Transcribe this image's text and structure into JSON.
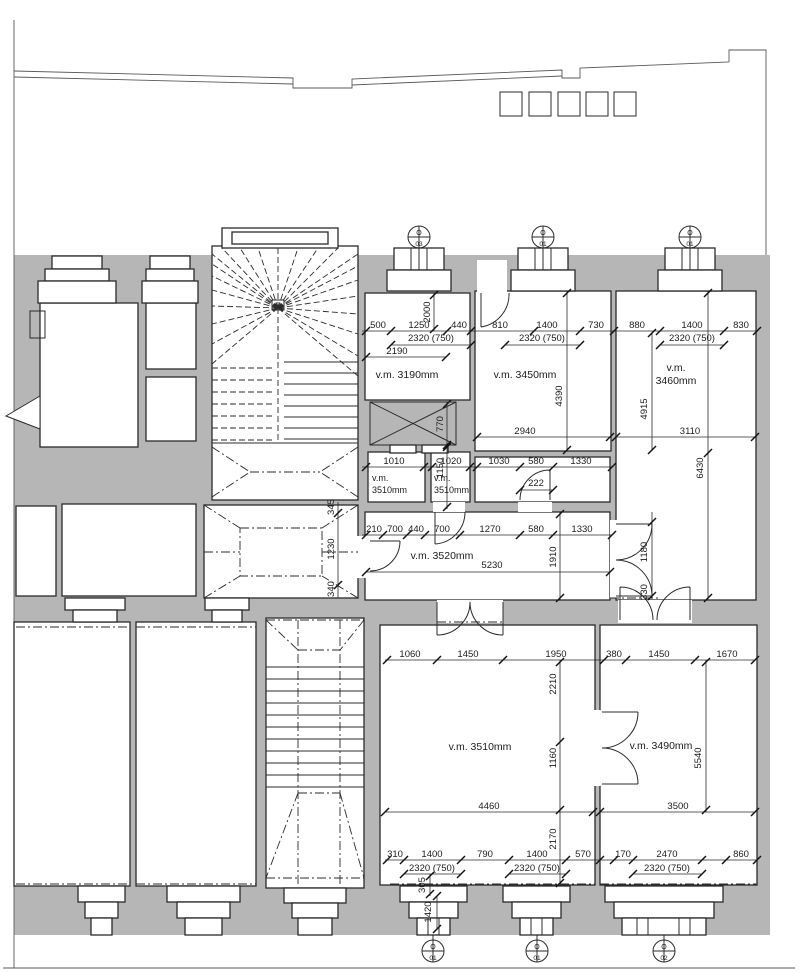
{
  "drawing": {
    "type": "architectural floor plan",
    "colors": {
      "wall_fill": "#b6b6b6",
      "line": "#2b2b2b",
      "background": "#ffffff"
    },
    "room_labels": {
      "r3190": "v.m. 3190mm",
      "r3450": "v.m. 3450mm",
      "r3460_l1": "v.m.",
      "r3460_l2": "3460mm",
      "r3510a_l1": "v.m.",
      "r3510a_l2": "3510mm",
      "r3510b_l1": "v.m.",
      "r3510b_l2": "3510mm",
      "r3520": "v.m. 3520mm",
      "r3510c": "v.m. 3510mm",
      "r3490": "v.m. 3490mm"
    },
    "dims": {
      "row1": [
        "500",
        "1250",
        "440",
        "810",
        "1400",
        "730",
        "880",
        "1400",
        "830"
      ],
      "row1_totals": [
        "2320 (750)",
        "2320 (750)",
        "2320 (750)"
      ],
      "sub": "2190",
      "row2": [
        "1010",
        "1020",
        "1030",
        "580",
        "1330"
      ],
      "row3": [
        "210",
        "700",
        "440",
        "700",
        "1270",
        "580",
        "1330"
      ],
      "row4": [
        "1060",
        "1450",
        "1950",
        "380",
        "1450",
        "1670"
      ],
      "row6": [
        "310",
        "1400",
        "790",
        "1400",
        "570",
        "170",
        "2470",
        "860"
      ],
      "row6_totals": [
        "2320 (750)",
        "2320 (750)",
        "2320 (750)"
      ],
      "d2940": "2940",
      "d3110": "3110",
      "d5230": "5230",
      "d4460": "4460",
      "d3500": "3500",
      "d222": "222",
      "v2000": "2000",
      "v770": "770",
      "v1150": "1150",
      "v4390": "4390",
      "v4915": "4915",
      "v6430": "6430",
      "v1910": "1910",
      "v1180": "1180",
      "v330": "330",
      "v345": "345",
      "v1230": "1230",
      "v340": "340",
      "v2210": "2210",
      "v1160": "1160",
      "v5540": "5540",
      "v2170": "2170",
      "v305": "305",
      "v1420": "1420"
    },
    "markers": {
      "top": [
        {
          "letter": "O",
          "num": "03"
        },
        {
          "letter": "O",
          "num": "01"
        },
        {
          "letter": "O",
          "num": "01"
        }
      ],
      "bottom": [
        {
          "letter": "O",
          "num": "01"
        },
        {
          "letter": "O",
          "num": "01"
        },
        {
          "letter": "O",
          "num": "02"
        }
      ]
    }
  }
}
